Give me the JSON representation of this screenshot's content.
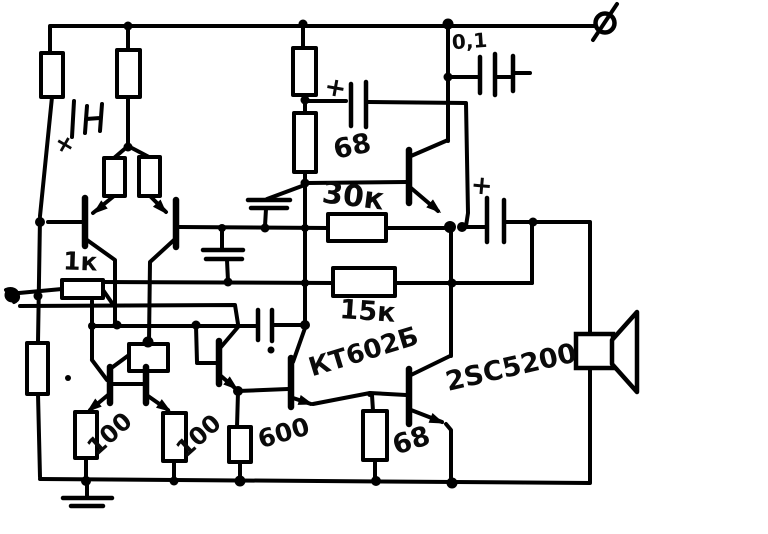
{
  "labels": {
    "c_out_coupling": "0,1",
    "r_bootstrap": "68",
    "r_feedback_30k": "30к",
    "r_feedback_15k": "15к",
    "r_input_1k": "1к",
    "t_driver": "КТ602Б",
    "t_output": "2SC5200",
    "r_emitter_left": "100",
    "r_emitter_right": "100",
    "r_vas_600": "600",
    "r_base_68": "68"
  },
  "marks": {
    "plus_supply_cap": "+",
    "plus_bootstrap_cap": "+",
    "plus_output_cap": "+"
  },
  "colors": {
    "ink": "#000000",
    "paper": "#ffffff"
  }
}
